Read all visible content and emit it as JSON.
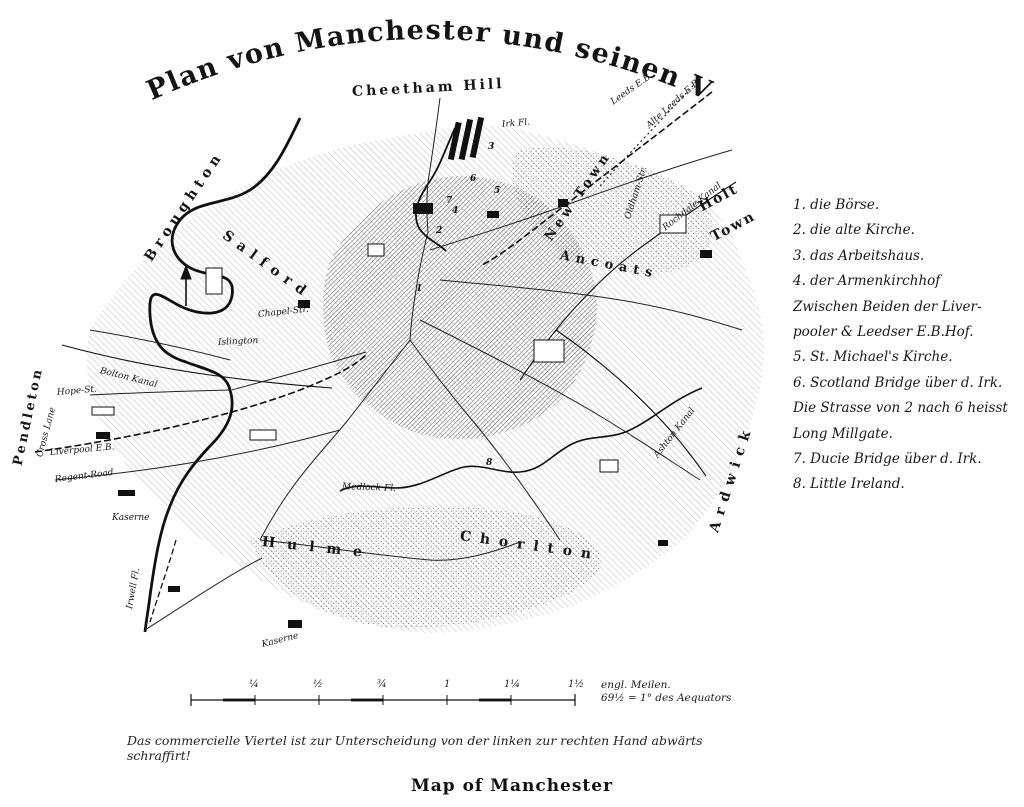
{
  "title": {
    "text": "Plan von Manchester und seinen Vorstädten"
  },
  "bottom_title": "Map of Manchester",
  "caption": "Das commercielle Viertel ist zur Unterscheidung von der linken zur rechten Hand abwärts schraffirt!",
  "legend": {
    "items": [
      {
        "text": "1.  die Börse."
      },
      {
        "text": "2.  die alte Kirche."
      },
      {
        "text": "3.  das Arbeitshaus."
      },
      {
        "text": "4.  der Armenkirchhof"
      },
      {
        "text": "Zwischen Beiden der Liver-"
      },
      {
        "text": "pooler & Leedser E.B.Hof."
      },
      {
        "text": "5.  St. Michael's Kirche."
      },
      {
        "text": "6.  Scotland Bridge über d. Irk."
      },
      {
        "text": "Die Strasse von 2 nach 6 heisst"
      },
      {
        "text": "Long Millgate."
      },
      {
        "text": "7.  Ducie Bridge über d. Irk."
      },
      {
        "text": "8.  Little Ireland."
      }
    ]
  },
  "scale": {
    "ticks": [
      "¼",
      "½",
      "¾",
      "1",
      "1¼",
      "1½"
    ],
    "unit_line1": "engl. Meilen.",
    "unit_line2": "69½ = 1° des Aequators"
  },
  "map": {
    "labels": [
      {
        "text": "Cheetham Hill"
      },
      {
        "text": "Broughton"
      },
      {
        "text": "Pendleton"
      },
      {
        "text": "Cross Lane"
      },
      {
        "text": "Salford"
      },
      {
        "text": "New Town"
      },
      {
        "text": "Ancoats"
      },
      {
        "text": "Holt"
      },
      {
        "text": "Town"
      },
      {
        "text": "Ardwick"
      },
      {
        "text": "Hulme"
      },
      {
        "text": "Chorlton"
      },
      {
        "text": "Irwell Fl."
      },
      {
        "text": "Irk Fl."
      },
      {
        "text": "Medlock Fl."
      },
      {
        "text": "Bolton Kanal"
      },
      {
        "text": "Rochdale-Kanal"
      },
      {
        "text": "Ashton Kanal"
      },
      {
        "text": "Hope-St."
      },
      {
        "text": "Liverpool E.B."
      },
      {
        "text": "Regent-Road"
      },
      {
        "text": "Kaserne"
      },
      {
        "text": "Kaserne"
      },
      {
        "text": "Leeds E.B."
      },
      {
        "text": "Alte Leeds E.B."
      },
      {
        "text": "Oldham-Str."
      },
      {
        "text": "Chapel-Str."
      },
      {
        "text": "Islington"
      }
    ],
    "markers": [
      {
        "n": "1"
      },
      {
        "n": "2"
      },
      {
        "n": "3"
      },
      {
        "n": "4"
      },
      {
        "n": "5"
      },
      {
        "n": "6"
      },
      {
        "n": "7"
      },
      {
        "n": "8"
      }
    ]
  },
  "colors": {
    "ink": "#1a1a1a",
    "paper": "#ffffff"
  }
}
